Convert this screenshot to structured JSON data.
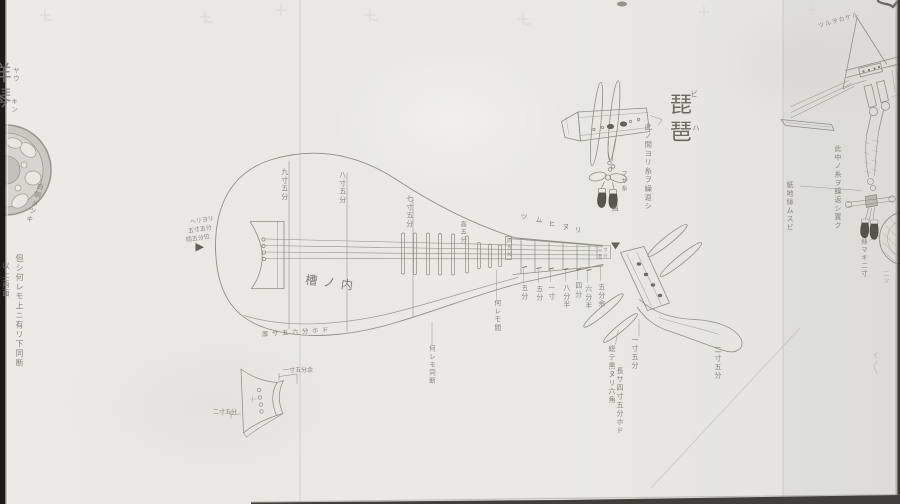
{
  "scroll": {
    "title": {
      "text": "琵琶",
      "furigana_top": "ビ",
      "furigana_bottom": "ハ"
    },
    "left_panel": {
      "heading": "洋琴",
      "heading_kana_top": "ヤウ",
      "heading_kana_bottom": "キン",
      "wheel_note": "白銅メツキ",
      "note_col_right": "但シ何レモ上ニ有リ下同断",
      "note_col_left": "以上両面"
    },
    "biwa": {
      "width_labels": [
        "九寸五分",
        "八寸五分",
        "七寸五分"
      ],
      "tailpiece_notes": [
        "ヘリヨリ",
        "五寸五分",
        "同五分位"
      ],
      "belly_note": "槽ノ内",
      "rim_note": "厚サ五六分ホド",
      "fret_height_note": "高五分",
      "fret_top_labels": [
        "ツ",
        "ム",
        "ヒ",
        "ヌ",
        "リ"
      ],
      "boxed_note": "同五分",
      "mid_note": "何レモ間",
      "under_rim_note": "何レモ同断",
      "fret_measures": [
        "五分",
        "五分",
        "一寸",
        "八分半",
        "四分",
        "六分半",
        "五分余"
      ],
      "nut_note": "一寸五分",
      "head_note_left": "一寸五分",
      "head_note_col1": "総テ黒ヌリ六角",
      "head_note_col2": "長サ四寸五分ホド",
      "head_note_right": "二寸五分"
    },
    "tassel_detail": {
      "main_note": "此ノ間ヨリ糸ヲ繰返シ",
      "small_note": "フサ糸",
      "bottom_note": "紐"
    },
    "bracket_detail": {
      "dim_right": "一寸五分余",
      "dim_left": "二寸五分"
    },
    "right_panel": {
      "diag_note": "ツルヲカケル",
      "long_note": "此中ノ糸ヲ繰返シ置ク",
      "left_note": "紙地絲ムスビ",
      "disc_note": "絲マキ二寸",
      "disc_small_note": "二ツ",
      "bottom_faint_note": "く〳〵"
    }
  }
}
